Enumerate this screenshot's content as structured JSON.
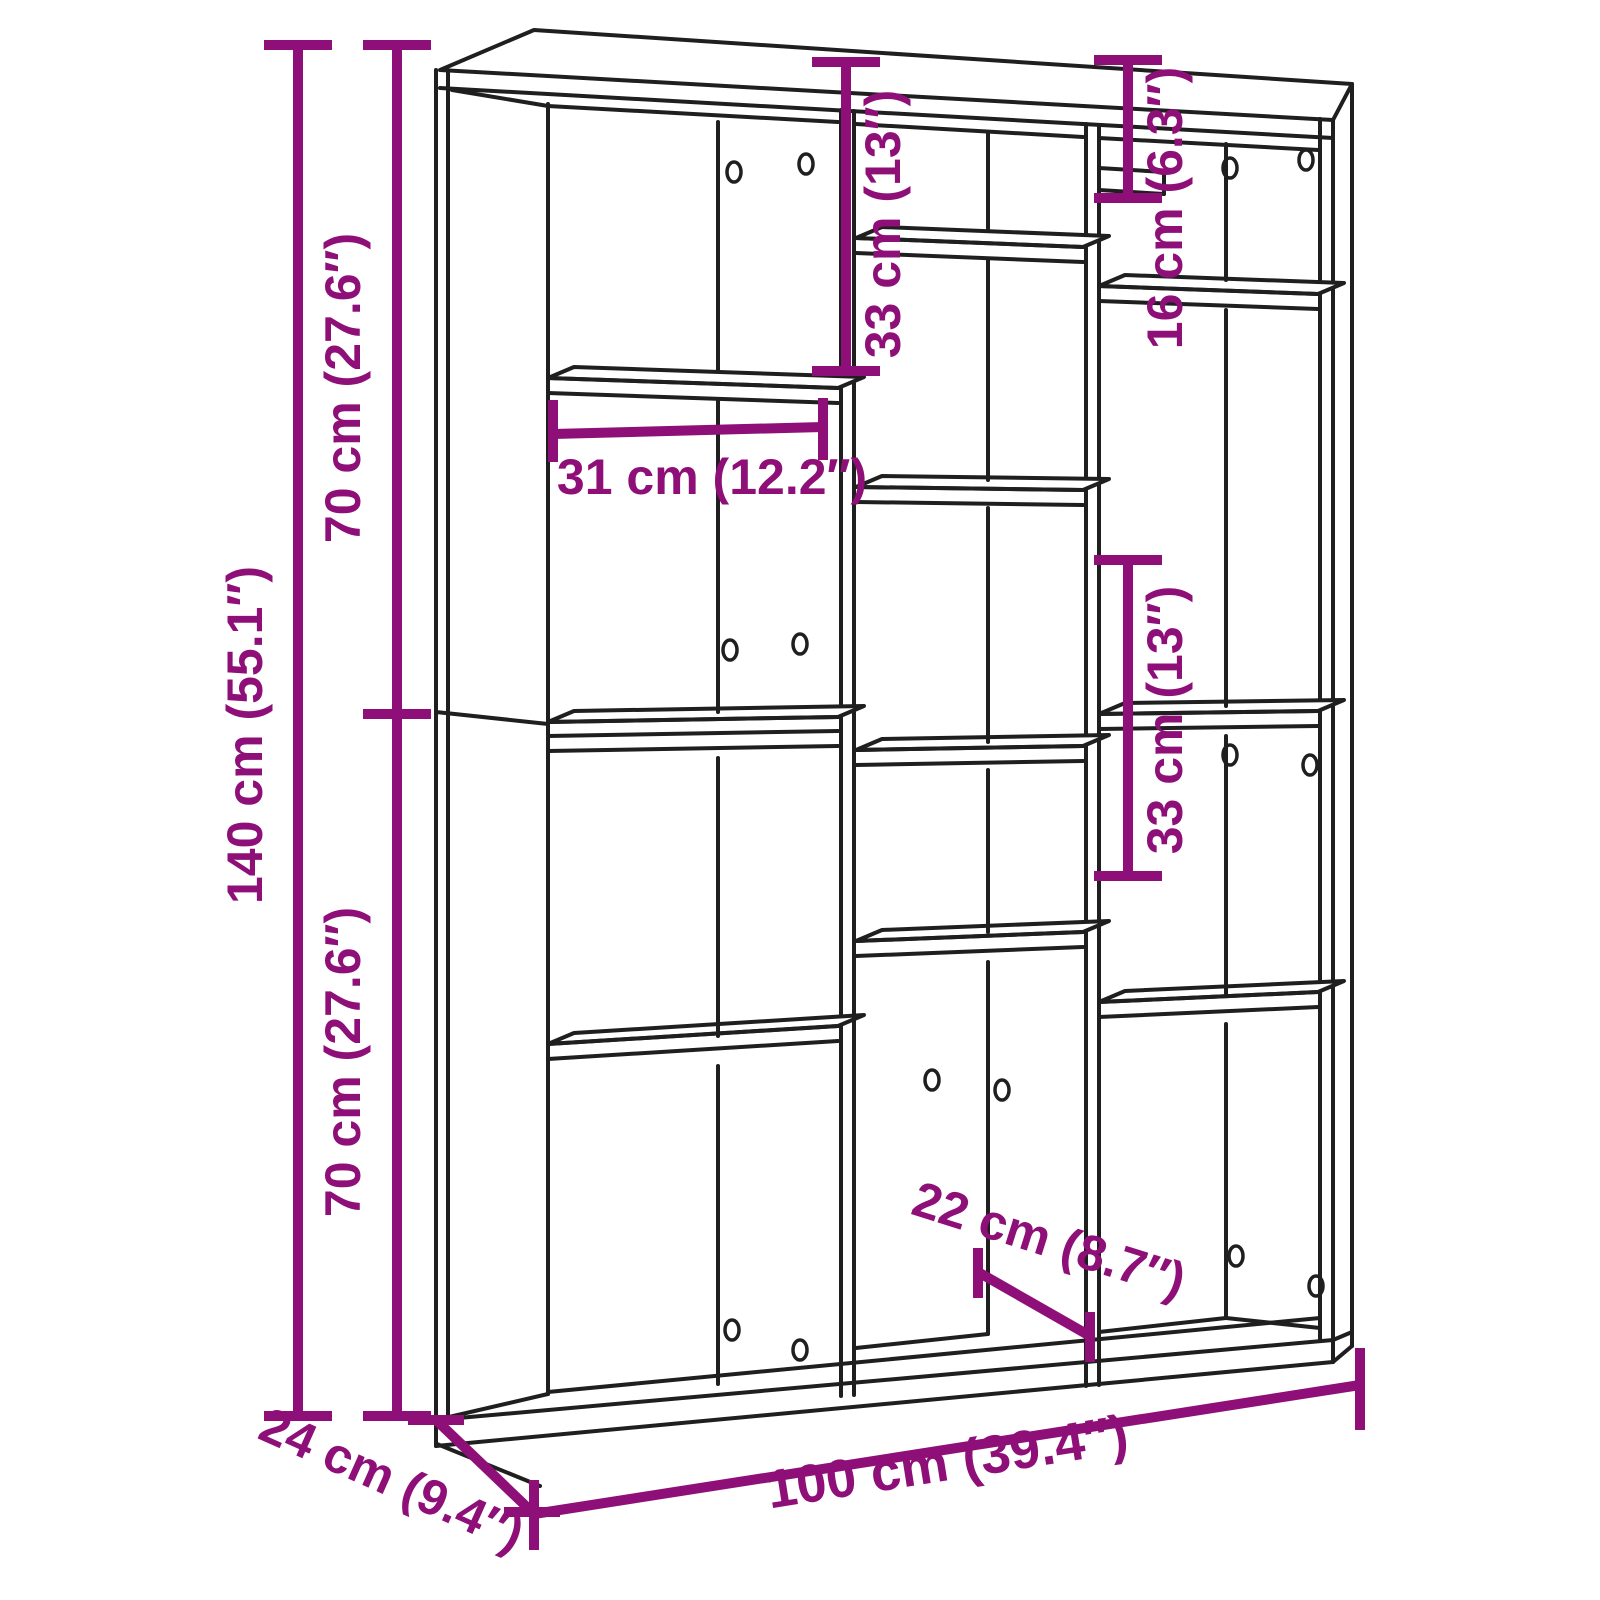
{
  "page": {
    "background_color": "#ffffff"
  },
  "diagram": {
    "kind": "furniture dimension line drawing",
    "subject": "bookshelf room divider with staggered open compartments, three-quarter view",
    "outline_color": "#1f1f1f",
    "dimension_color": "#8E0F77",
    "dimensions": {
      "total_height": {
        "label": "140 cm (55.1″)",
        "cm": 140,
        "inches": 55.1
      },
      "upper_section_height": {
        "label": "70 cm (27.6″)",
        "cm": 70,
        "inches": 27.6
      },
      "lower_section_height": {
        "label": "70 cm (27.6″)",
        "cm": 70,
        "inches": 27.6
      },
      "middle_top_compartment_height": {
        "label": "33 cm (13″)",
        "cm": 33,
        "inches": 13
      },
      "right_top_compartment_height": {
        "label": "16 cm (6.3″)",
        "cm": 16,
        "inches": 6.3
      },
      "left_compartment_width": {
        "label": "31 cm (12.2″)",
        "cm": 31,
        "inches": 12.2
      },
      "right_middle_compartment_height": {
        "label": "33 cm (13″)",
        "cm": 33,
        "inches": 13
      },
      "middle_bottom_compartment_width": {
        "label": "22 cm (8.7″)",
        "cm": 22,
        "inches": 8.7
      },
      "total_width": {
        "label": "100 cm (39.4″)",
        "cm": 100,
        "inches": 39.4
      },
      "total_depth": {
        "label": "24 cm (9.4″)",
        "cm": 24,
        "inches": 9.4
      }
    }
  }
}
